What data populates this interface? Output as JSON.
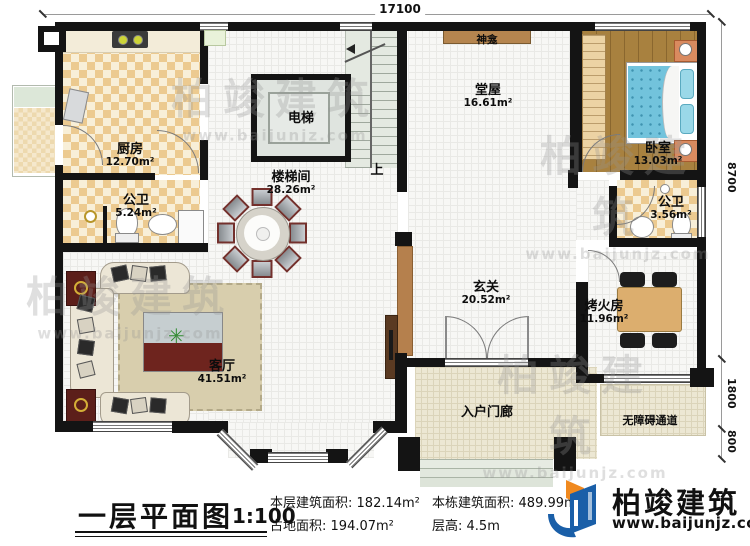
{
  "plan": {
    "dim_top": "17100",
    "dims_right": [
      "8700",
      "1800",
      "800"
    ],
    "stair_up": "上",
    "rooms": [
      {
        "name": "厨房",
        "area": "12.70m²"
      },
      {
        "name": "公卫",
        "area": "5.24m²"
      },
      {
        "name": "电梯",
        "area": ""
      },
      {
        "name": "楼梯间",
        "area": "28.26m²"
      },
      {
        "name": "堂屋",
        "area": "16.61m²"
      },
      {
        "name": "神龛",
        "area": ""
      },
      {
        "name": "卧室",
        "area": "13.03m²"
      },
      {
        "name": "公卫",
        "area": "3.56m²"
      },
      {
        "name": "玄关",
        "area": "20.52m²"
      },
      {
        "name": "烤火房",
        "area": "11.96m²"
      },
      {
        "name": "客厅",
        "area": "41.51m²"
      },
      {
        "name": "入户门廊",
        "area": ""
      },
      {
        "name": "无障碍通道",
        "area": ""
      }
    ]
  },
  "titleblock": {
    "title": "一层平面图",
    "scale": "1:100",
    "stats": [
      {
        "label": "本层建筑面积:",
        "value": "182.14m²"
      },
      {
        "label": "占地面积:",
        "value": "194.07m²"
      },
      {
        "label": "本栋建筑面积:",
        "value": "489.99m²"
      },
      {
        "label": "层高:",
        "value": "4.5m"
      }
    ],
    "brand_name": "柏竣建筑",
    "brand_url": "www.baijunjz.com"
  },
  "watermark": {
    "text": "柏竣建筑",
    "url": "www.baijunjz.com"
  }
}
